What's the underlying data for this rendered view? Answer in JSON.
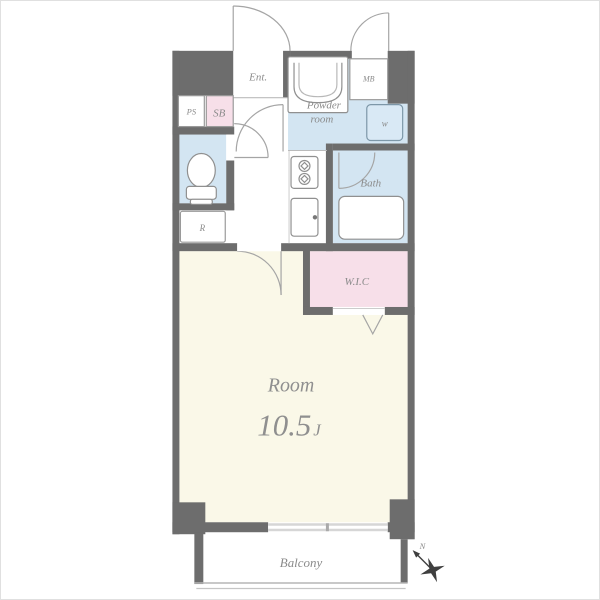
{
  "plan_title": "apartment-floor-plan",
  "colors": {
    "wall": "#6d6d6d",
    "room_floor": "#faf8e8",
    "wet_floor": "#d3e5f2",
    "closet_floor": "#f7dfe9",
    "fixture_stroke": "#909090",
    "label": "#8b8b8b",
    "window": "#d6d6d6",
    "compass": "#3f3f3f",
    "background": "#ffffff"
  },
  "rooms": {
    "entrance": {
      "label": "Ent."
    },
    "pipe_space": {
      "label": "PS"
    },
    "shoe_box": {
      "label": "SB"
    },
    "meter_box": {
      "label": "MB"
    },
    "powder_room": {
      "label_line1": "Powder",
      "label_line2": "room"
    },
    "washer": {
      "label": "w"
    },
    "refrigerator": {
      "label": "R"
    },
    "bath": {
      "label": "Bath"
    },
    "walk_in_closet": {
      "label": "W.I.C"
    },
    "main_room": {
      "label": "Room",
      "size_value": "10.5",
      "size_unit": "J"
    },
    "balcony": {
      "label": "Balcony"
    }
  },
  "compass": {
    "label": "N"
  }
}
